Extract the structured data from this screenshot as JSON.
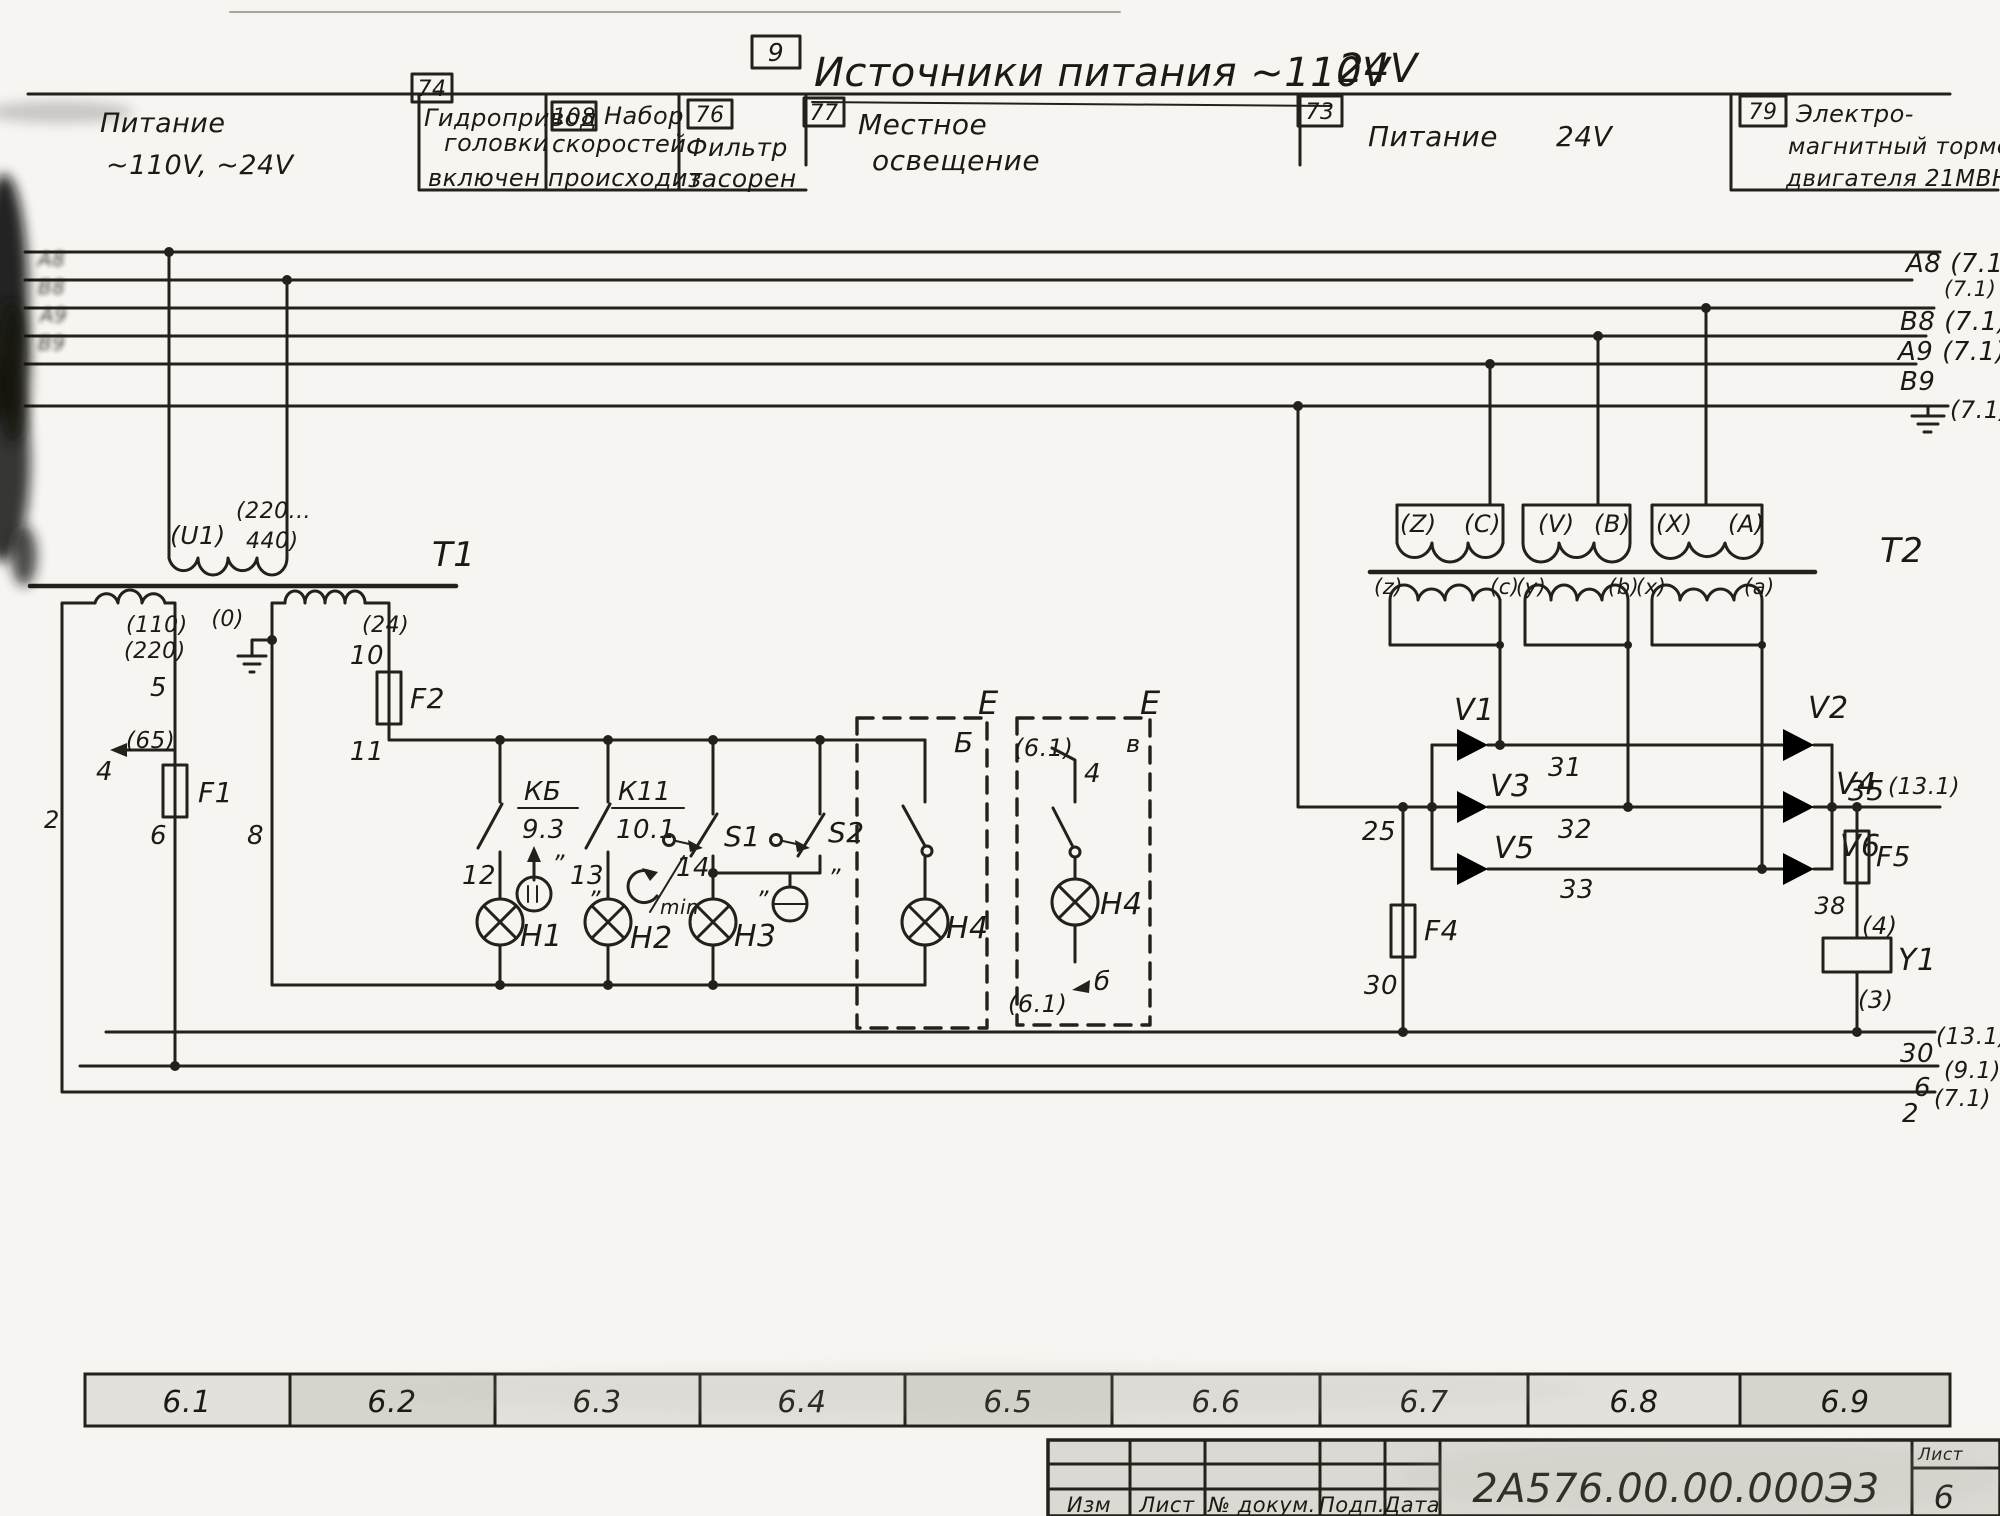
{
  "sheet": {
    "ref_no": "9",
    "title_main": "Источники питания ~110V",
    "title_suffix": "24V",
    "doc_number": "2А576.00.00.000Э3",
    "sheet_label": "Лист",
    "sheet_no": "6",
    "zones": [
      "6.1",
      "6.2",
      "6.3",
      "6.4",
      "6.5",
      "6.6",
      "6.7",
      "6.8",
      "6.9"
    ],
    "title_block_cols": [
      "Изм",
      "Лист",
      "№ докум.",
      "Подп.",
      "Дата"
    ]
  },
  "header": {
    "power_line1": "Питание",
    "power_line2": "~110V, ~24V",
    "c74_ref": "74",
    "c74_l1": "Гидропривод",
    "c74_l2": "головки",
    "c74_l3": "включен",
    "c108_ref": "108",
    "c108_l1": "Набор",
    "c108_l2": "скоростей",
    "c108_l3": "происходит",
    "c76_ref": "76",
    "c76_l1": "Фильтр",
    "c76_l2": "засорен",
    "c77_ref": "77",
    "c77_l1": "Местное",
    "c77_l2": "освещение",
    "c73_ref": "73",
    "c73_l1": "Питание",
    "c73_l2": "24V",
    "c79_ref": "79",
    "c79_l1": "Электро-",
    "c79_l2": "магнитный тормоз",
    "c79_l3": "двигателя 21МВН"
  },
  "bus": {
    "a8": "А8 (7.1)",
    "x71": "(7.1)",
    "b8": "В8 (7.1)",
    "a9": "А9 (7.1)",
    "b9": "В9",
    "gnd": "(7.1)",
    "left1": "А8",
    "left2": "В8",
    "left3": "А9",
    "left4": "В9"
  },
  "t1": {
    "name": "Т1",
    "u1": "(U1)",
    "prim_v1": "(220...",
    "prim_v2": "440)",
    "w110": "(110)",
    "w220": "(220)",
    "t5": "5",
    "t65": "(65)",
    "t4": "4",
    "f1": "F1",
    "t6": "6",
    "t0": "(0)",
    "t8": "8",
    "w24": "(24)",
    "t10": "10",
    "f2": "F2",
    "t11": "11",
    "t2wire": "2"
  },
  "lamps": {
    "kb_top": "КБ",
    "kb_bot": "9.3",
    "k11_top": "К11",
    "k11_bot": "10.1",
    "t12": "12",
    "t13": "13",
    "t14": "14",
    "min": "min",
    "s1": "S1",
    "s2": "S2",
    "h1": "Н1",
    "h2": "Н2",
    "h3": "Н3",
    "h4": "Н4",
    "h4b": "Н4",
    "e1": "Е",
    "e1_sub": "Б",
    "e2": "Е",
    "e2_sub": "в",
    "ref61_top": "(6.1)",
    "t4b": "4",
    "ref61_bot": "(6.1)",
    "tb": "б",
    "ditto": "”"
  },
  "t2": {
    "name": "Т2",
    "pz": "(Z)",
    "pc": "(C)",
    "pv": "(V)",
    "pb": "(B)",
    "px": "(X)",
    "pa": "(A)",
    "sz": "(z)",
    "sc": "(c)",
    "sy": "(y)",
    "sb": "(b)",
    "sx": "(x)",
    "sa": "(a)"
  },
  "rect": {
    "v1": "V1",
    "v2": "V2",
    "v3": "V3",
    "v4": "V4",
    "v5": "V5",
    "v6": "V6",
    "t25": "25",
    "t31": "31",
    "t32": "32",
    "t33": "33",
    "f4": "F4",
    "t30": "30",
    "f5": "F5",
    "t38": "38",
    "y1": "Y1",
    "p4": "(4)",
    "p3": "(3)",
    "t35": "35",
    "ref131": "(13.1)"
  },
  "outputs": {
    "o30": "30",
    "o30r": "(13.1)",
    "o6": "6",
    "o6r": "(9.1)",
    "o2": "2",
    "o2r": "(7.1)"
  }
}
